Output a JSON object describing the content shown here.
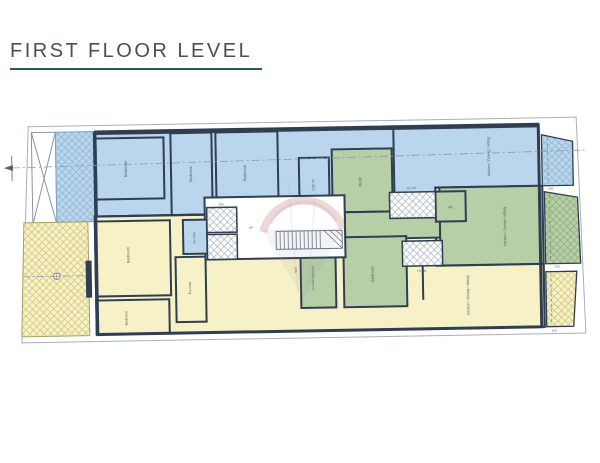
{
  "header": {
    "title": "FIRST FLOOR LEVEL",
    "underline_color": "#2d5c4e"
  },
  "palette": {
    "apartment_blue": "#b9d6ec",
    "apartment_blue_hatch": "#8fb3d4",
    "apartment_yellow": "#f6f1c6",
    "apartment_yellow_hatch": "#cfc27a",
    "apartment_green": "#b7cfa6",
    "apartment_green_hatch": "#8cab7c",
    "wall": "#2f3e52",
    "boundary": "#a9b0b8",
    "label": "#55606e",
    "watermark_red": "#b5534f",
    "watermark_gray": "#8b95a0"
  },
  "plan": {
    "labels": [
      {
        "name": "label-bedroom-blue-1",
        "text": "Bedroom",
        "x": 128,
        "y": 166,
        "rot": -90,
        "size": 4
      },
      {
        "name": "label-bedroom-blue-2",
        "text": "Bedroom",
        "x": 193,
        "y": 172,
        "rot": -90,
        "size": 4
      },
      {
        "name": "label-bedroom-blue-3",
        "text": "Bedroom",
        "x": 247,
        "y": 172,
        "rot": -90,
        "size": 4
      },
      {
        "name": "label-bath-rm",
        "text": "bath rm",
        "x": 315,
        "y": 185,
        "rot": -90,
        "size": 3.5
      },
      {
        "name": "label-kitchen-blue",
        "text": "kitchen / Dining / sitting",
        "x": 491,
        "y": 160,
        "rot": -90,
        "size": 3.8
      },
      {
        "name": "label-ensuite-blue",
        "text": "En-suite",
        "x": 195,
        "y": 236,
        "rot": -90,
        "size": 3.2
      },
      {
        "name": "label-hlw-top",
        "text": "H.L.W",
        "x": 412,
        "y": 191,
        "rot": 0,
        "size": 3.2
      },
      {
        "name": "label-study",
        "text": "study",
        "x": 362,
        "y": 183,
        "rot": -90,
        "size": 4
      },
      {
        "name": "label-wc",
        "text": "Wc",
        "x": 451,
        "y": 211,
        "rot": 0,
        "size": 3.5
      },
      {
        "name": "label-kitchen-green",
        "text": "kitchen / Dining / sitting",
        "x": 506,
        "y": 230,
        "rot": -90,
        "size": 3.8
      },
      {
        "name": "label-bedroom-green",
        "text": "Bedroom",
        "x": 373,
        "y": 275,
        "rot": -90,
        "size": 4
      },
      {
        "name": "label-ensuite-green",
        "text": "En-suite bathroom",
        "x": 313,
        "y": 278,
        "rot": -90,
        "size": 3
      },
      {
        "name": "label-hlw-right",
        "text": "H.L.W",
        "x": 421,
        "y": 274,
        "rot": 0,
        "size": 3.2
      },
      {
        "name": "label-bedroom-yellow-1",
        "text": "Bedroom",
        "x": 129,
        "y": 252,
        "rot": -90,
        "size": 4
      },
      {
        "name": "label-bedroom-yellow-2",
        "text": "Bedroom",
        "x": 126,
        "y": 315,
        "rot": -90,
        "size": 3.6
      },
      {
        "name": "label-ensuite-yellow",
        "text": "En-suite",
        "x": 190,
        "y": 286,
        "rot": -90,
        "size": 3.5
      },
      {
        "name": "label-kitchen-yellow",
        "text": "kitchen / Dining / sitting",
        "x": 468,
        "y": 298,
        "rot": -90,
        "size": 3.8
      },
      {
        "name": "label-hall",
        "text": "hall",
        "x": 296,
        "y": 270,
        "rot": -90,
        "size": 3.5
      },
      {
        "name": "label-up",
        "text": "UP",
        "x": 251,
        "y": 228,
        "rot": 0,
        "size": 3.2
      },
      {
        "name": "label-level-shaft",
        "text": "-150",
        "x": 221,
        "y": 204,
        "rot": 0,
        "size": 3
      },
      {
        "name": "label-level-hlw",
        "text": "-100",
        "x": 420,
        "y": 241,
        "rot": 0,
        "size": 3
      },
      {
        "name": "label-level-balcony-blue",
        "text": "-100",
        "x": 551,
        "y": 194,
        "rot": 0,
        "size": 3
      },
      {
        "name": "label-level-balcony-green",
        "text": "-100",
        "x": 556,
        "y": 272,
        "rot": 0,
        "size": 3
      },
      {
        "name": "label-level-balcony-yellow",
        "text": "-100",
        "x": 552,
        "y": 336,
        "rot": 0,
        "size": 3
      }
    ]
  }
}
